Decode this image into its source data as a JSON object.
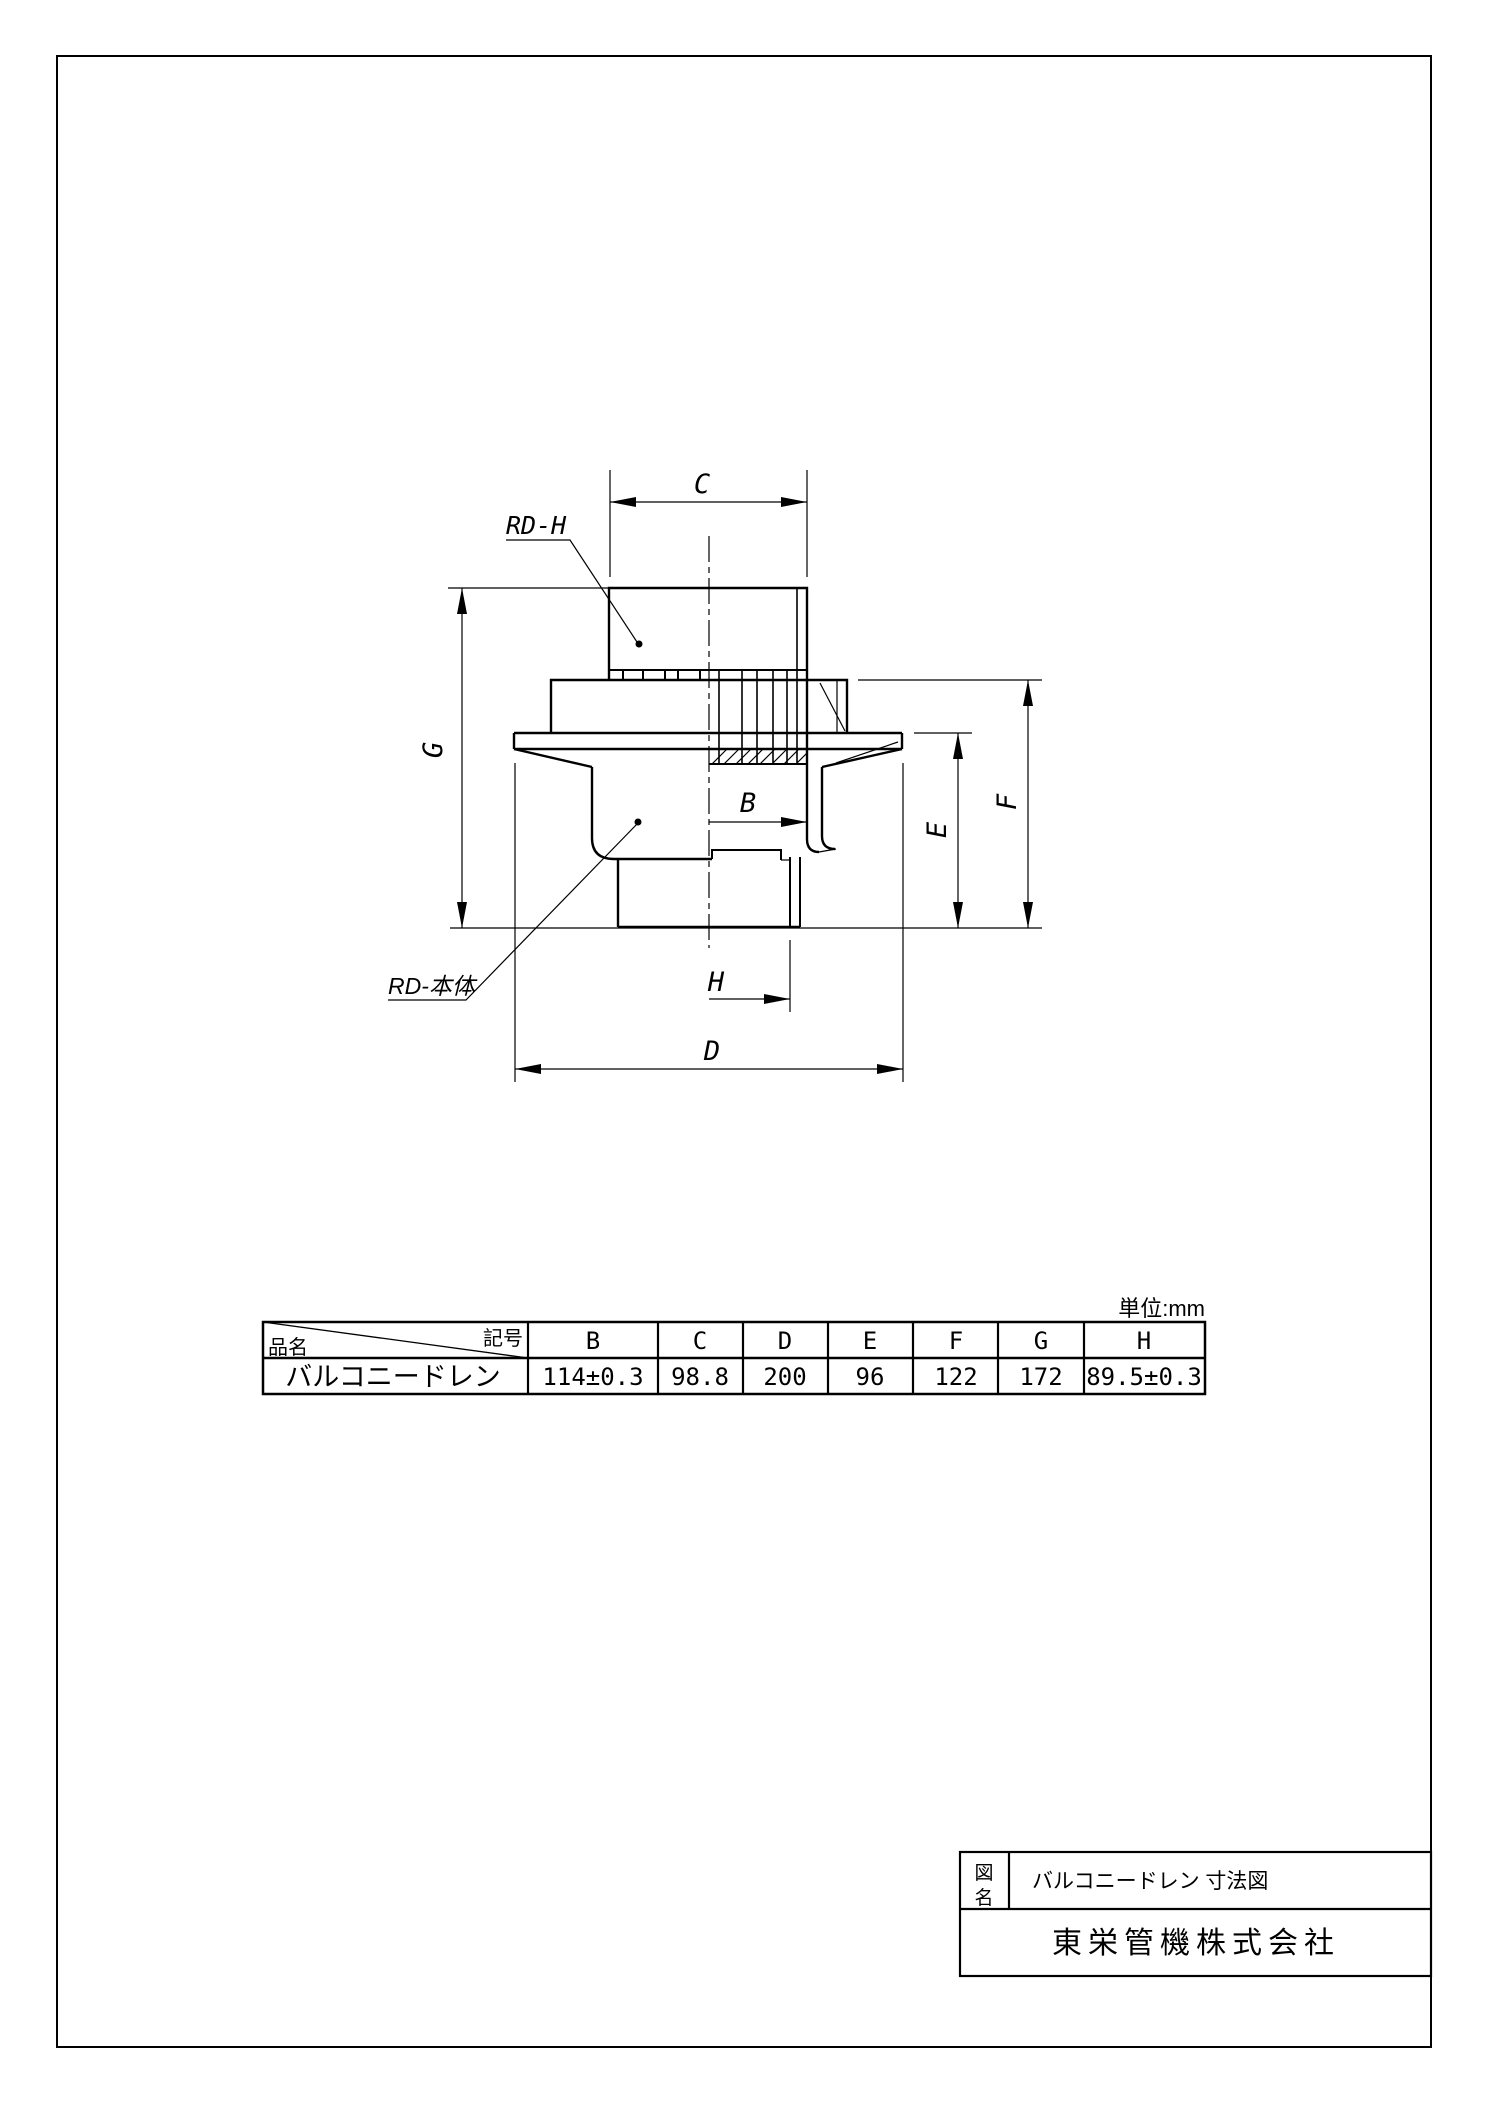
{
  "unit_note": "単位:mm",
  "dims": {
    "b": "B",
    "c": "C",
    "d": "D",
    "e": "E",
    "f": "F",
    "g": "G",
    "h": "H"
  },
  "leaders": {
    "cap_label": "RD-H",
    "body_label": "RD-本体"
  },
  "spec_table": {
    "name_header": "品名",
    "symbol_header": "記号",
    "columns": [
      "B",
      "C",
      "D",
      "E",
      "F",
      "G",
      "H"
    ],
    "product": "バルコニードレン",
    "values": [
      "114±0.3",
      "98.8",
      "200",
      "96",
      "122",
      "172",
      "89.5±0.3"
    ]
  },
  "title_block": {
    "field_char_top": "図",
    "field_char_bottom": "名",
    "title": "バルコニードレン 寸法図",
    "company": "東栄管機株式会社"
  }
}
